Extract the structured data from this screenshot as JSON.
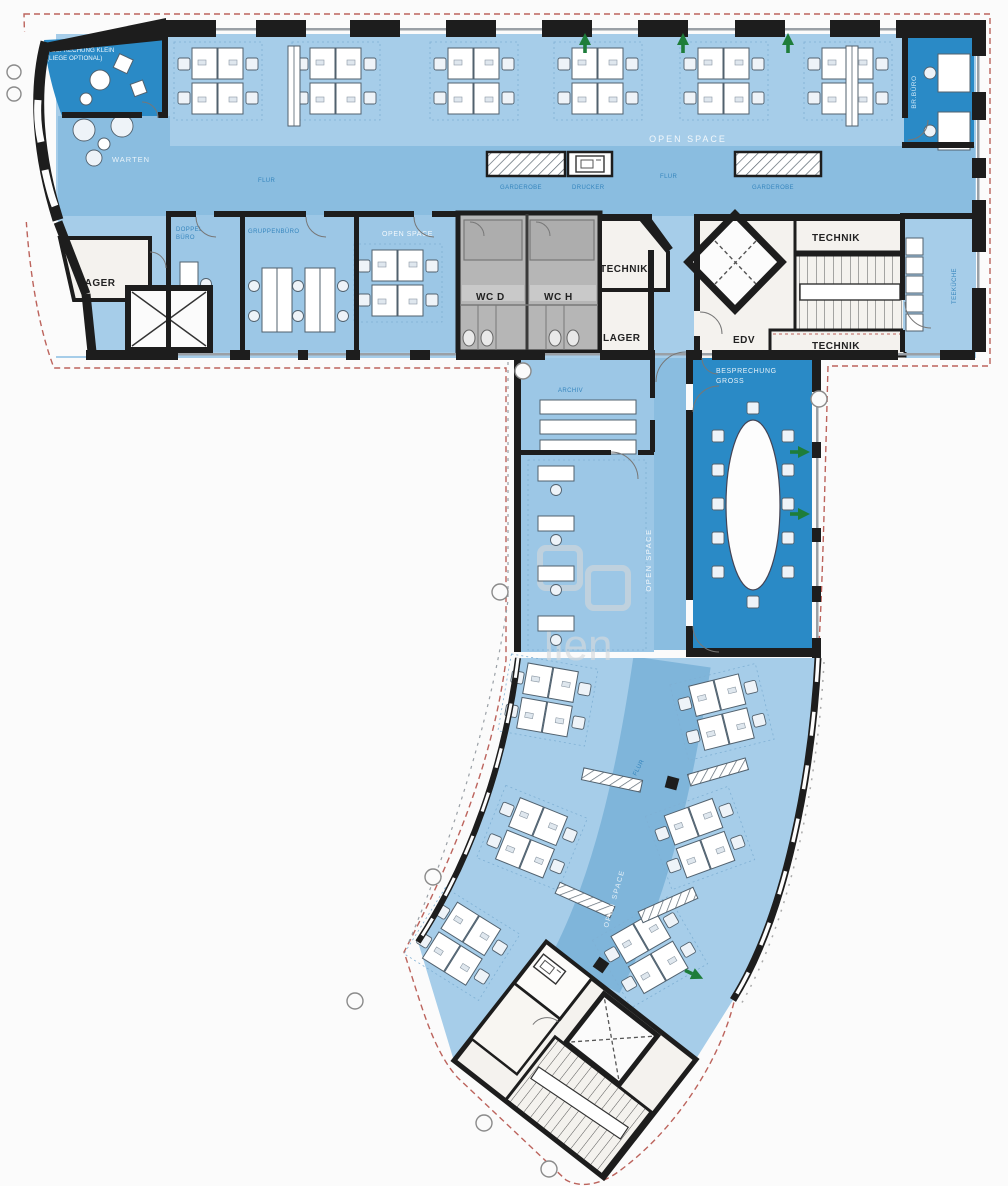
{
  "document": {
    "type": "floor-plan",
    "description": "Office floor plan, T-shaped wing with curved lower tract"
  },
  "labels": {
    "besprechung_klein_1": "BESPRECHUNG KLEIN",
    "besprechung_klein_2": "(LIEGE OPTIONAL)",
    "warten": "WARTEN",
    "open_space": "OPEN SPACE",
    "flur": "FLUR",
    "garderobe": "GARDEROBE",
    "drucker": "DRUCKER",
    "br_buero": "BR.BÜRO",
    "doppelbuero_1": "DOPPEL",
    "doppelbuero_2": "BÜRO",
    "gruppenbuero": "GRUPPENBÜRO",
    "lager": "LAGER",
    "wc_d": "WC D",
    "wc_h": "WC H",
    "technik": "TECHNIK",
    "edv": "EDV",
    "teekueche": "TEEKÜCHE",
    "archiv": "ARCHIV",
    "besprechung_gross_1": "BESPRECHUNG",
    "besprechung_gross_2": "GROSS",
    "watermark": "lien"
  },
  "colors": {
    "wall": "#1d1d1d",
    "floor_light": "#a6cde9",
    "floor_medium": "#9cc7e6",
    "floor_corridor": "#8abde0",
    "room_dark": "#2a8ac6",
    "wc_gray": "#b6b6b6",
    "boundary_red": "#b5524a",
    "arrow_green": "#1e7d3a",
    "label_blue": "#3585bd"
  }
}
